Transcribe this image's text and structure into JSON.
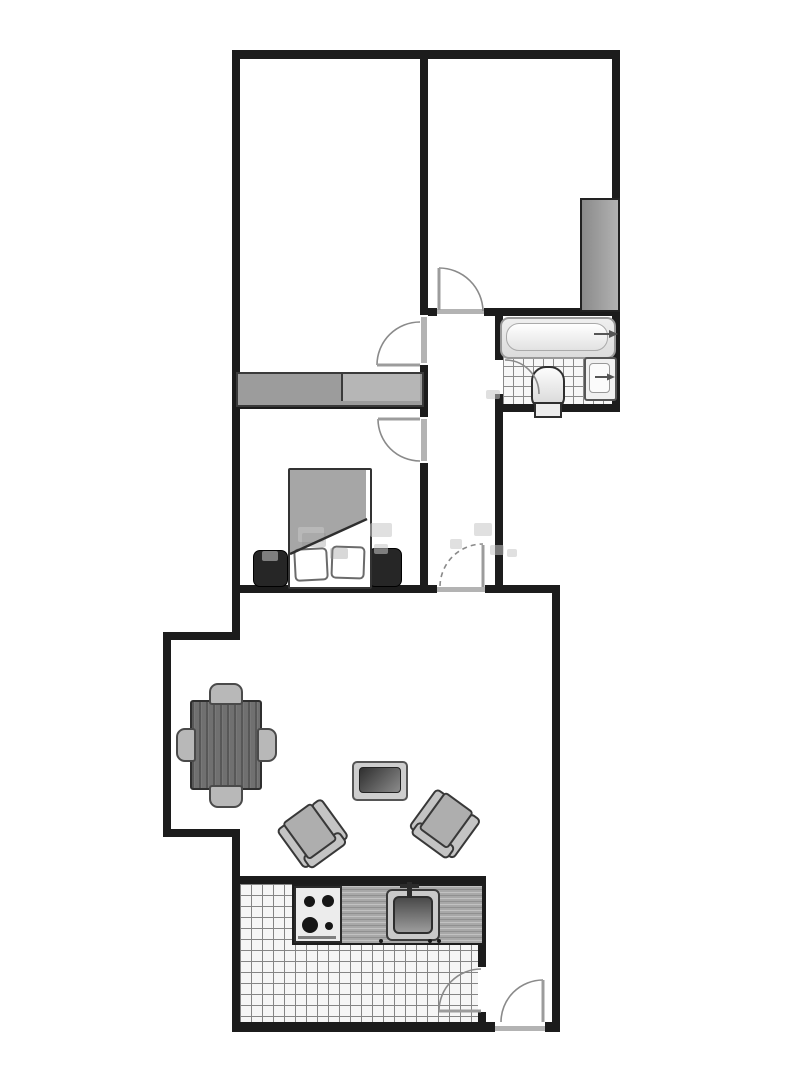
{
  "diagram": {
    "type": "floor-plan",
    "visible_text": "none",
    "colors": {
      "background": "#ffffff",
      "walls": "#1c1c1c",
      "door_swing": "#8a8a8a",
      "threshold": "#b3b3b3",
      "furniture_dark": "#707070",
      "furniture_light": "#c4c4c4",
      "nightstand": "#262626",
      "tile_line": "#858585"
    },
    "rooms": [
      {
        "id": "room-top-left",
        "floor": "plain",
        "furniture": [
          "low-wardrobe-band-two-sections"
        ]
      },
      {
        "id": "room-top-right",
        "floor": "plain",
        "furniture": [
          "tall-wardrobe"
        ]
      },
      {
        "id": "bathroom",
        "floor": "tiled",
        "fixtures": [
          "bathtub-with-faucet-arrow",
          "toilet",
          "wash-basin-with-faucet-arrow"
        ]
      },
      {
        "id": "hallway",
        "floor": "plain",
        "furniture": []
      },
      {
        "id": "bedroom",
        "floor": "plain",
        "furniture": [
          "double-bed-with-blanket",
          "pillow",
          "pillow",
          "nightstand-left",
          "nightstand-right"
        ]
      },
      {
        "id": "living-room",
        "floor": "plain",
        "furniture": [
          "dining-table",
          "chair-top",
          "chair-bottom",
          "chair-left",
          "chair-right",
          "coffee-table",
          "armchair-left",
          "armchair-right"
        ]
      },
      {
        "id": "kitchen",
        "floor": "tiled",
        "fixtures": [
          "counter",
          "stove-4-burner",
          "kitchen-sink-with-faucet"
        ]
      },
      {
        "id": "entry-vestibule",
        "floor": "plain",
        "furniture": []
      }
    ],
    "doors": [
      {
        "id": "door-top-right-room",
        "swings_into": "room-top-right"
      },
      {
        "id": "door-top-left-room",
        "swings_into": "room-top-left"
      },
      {
        "id": "door-bedroom",
        "swings_into": "bedroom"
      },
      {
        "id": "door-bathroom",
        "swings_into": "bathroom"
      },
      {
        "id": "door-hallway-living",
        "swings_into": "hallway",
        "style": "dashed-arc"
      },
      {
        "id": "door-kitchen",
        "swings_into": "kitchen"
      },
      {
        "id": "door-entrance",
        "swings_into": "entry-vestibule",
        "location": "bottom-wall"
      }
    ],
    "watermark": {
      "present": true,
      "legible": false
    }
  }
}
